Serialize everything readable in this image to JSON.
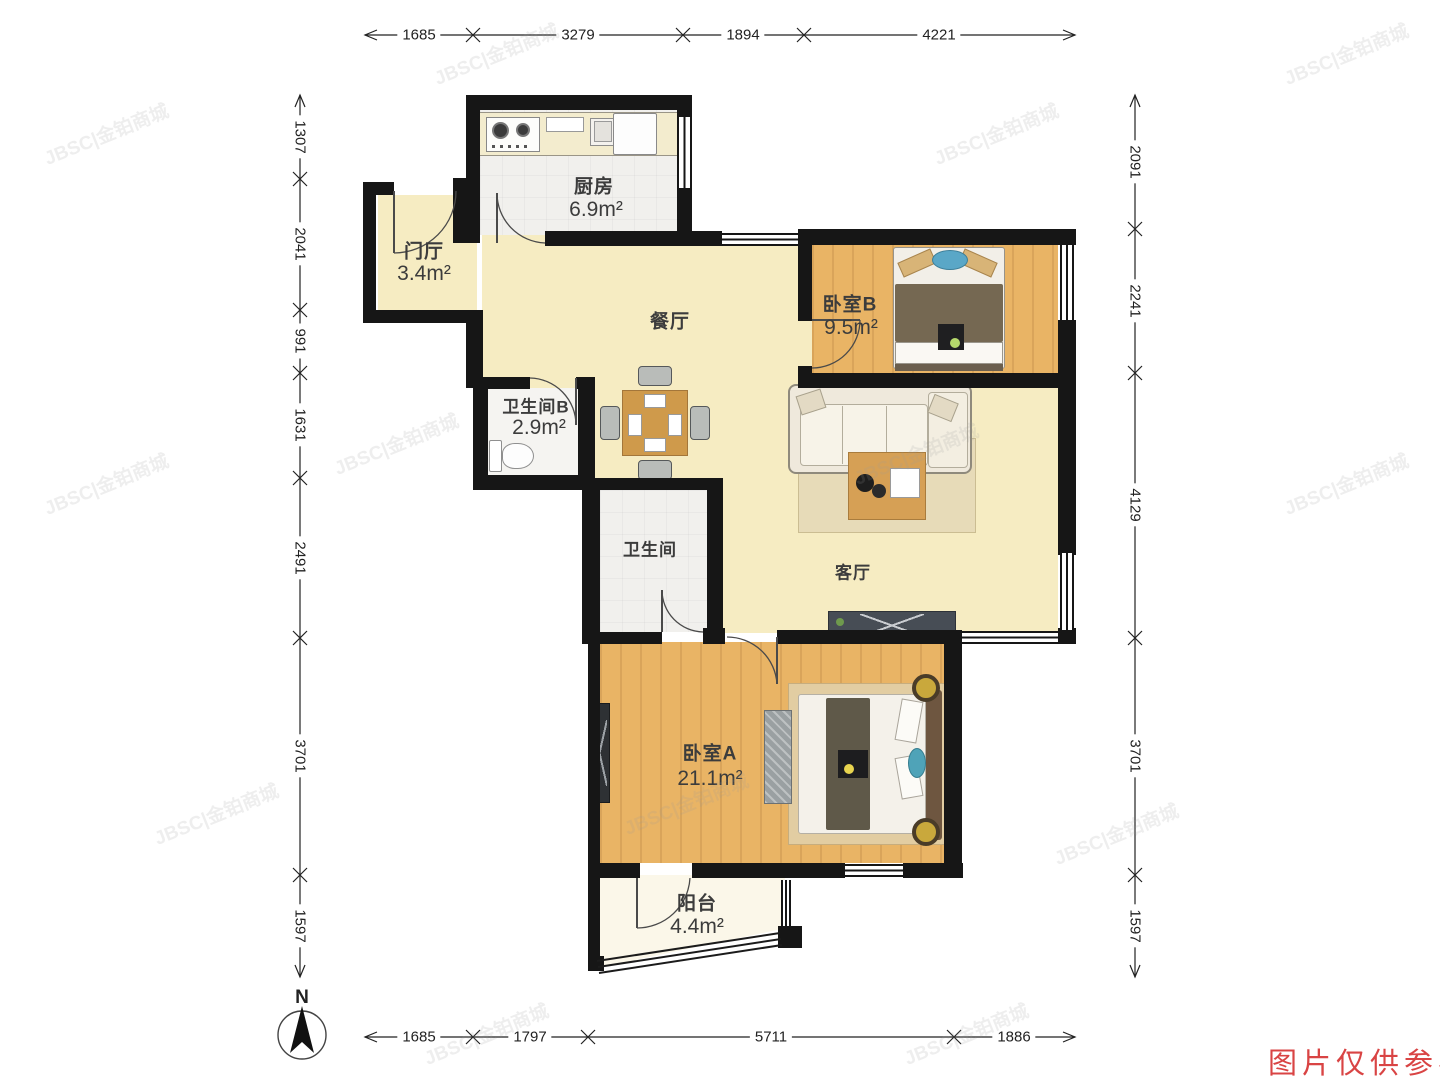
{
  "watermark": {
    "brand": "JBSC|金铂商城",
    "notice": "图片仅供参考"
  },
  "compass": {
    "label": "N"
  },
  "rooms": {
    "kitchen": {
      "name": "厨房",
      "area": "6.9m²"
    },
    "hall": {
      "name": "门厅",
      "area": "3.4m²"
    },
    "dining": {
      "name": "餐厅"
    },
    "bedroom_b": {
      "name": "卧室B",
      "area": "9.5m²"
    },
    "bathroom_b": {
      "name": "卫生间B",
      "area": "2.9m²"
    },
    "bathroom": {
      "name": "卫生间"
    },
    "living": {
      "name": "客厅"
    },
    "bedroom_a": {
      "name": "卧室A",
      "area": "21.1m²"
    },
    "balcony": {
      "name": "阳台",
      "area": "4.4m²"
    }
  },
  "dimensions": {
    "top": [
      "1685",
      "3279",
      "1894",
      "4221"
    ],
    "bottom": [
      "1685",
      "1797",
      "5711",
      "1886"
    ],
    "left": [
      "1307",
      "2041",
      "991",
      "1631",
      "2491",
      "3701",
      "1597"
    ],
    "right": [
      "2091",
      "2241",
      "4129",
      "3701",
      "1597"
    ]
  }
}
